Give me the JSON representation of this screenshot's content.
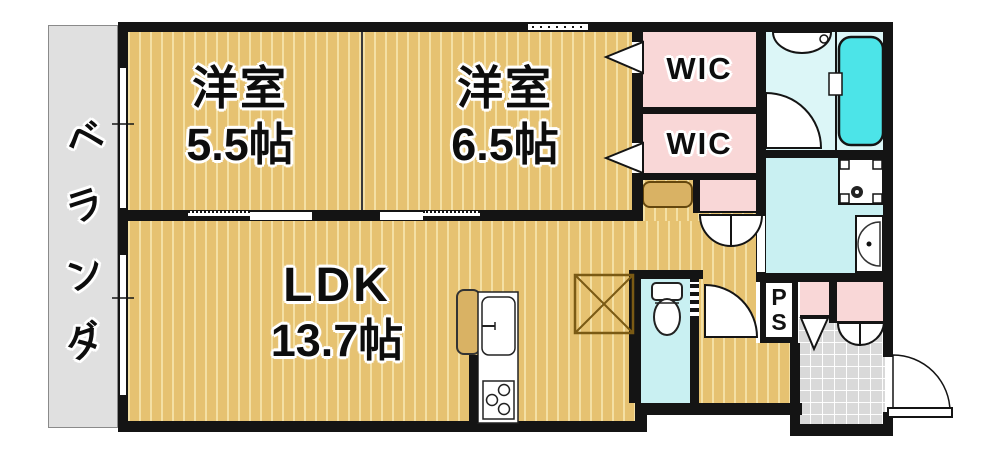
{
  "plan": {
    "veranda": {
      "label": "ベランダ"
    },
    "bedroom1": {
      "name": "洋室",
      "size": "5.5帖"
    },
    "bedroom2": {
      "name": "洋室",
      "size": "6.5帖"
    },
    "ldk": {
      "name": "LDK",
      "size": "13.7帖"
    },
    "wic1": {
      "label": "WIC"
    },
    "wic2": {
      "label": "WIC"
    },
    "pipe_space": {
      "line1": "P",
      "line2": "S"
    }
  },
  "colors": {
    "floor_tan": "#e6c271",
    "floor_stripe": "#f4e0a4",
    "counter_tan": "#d9b264",
    "pink": "#f9d7d7",
    "cyan_room": "#c9f0f2",
    "bath_floor": "#dcf6f7",
    "tub_cyan": "#4ce4e8",
    "veranda_gray": "#e0e0e0",
    "tile_gray": "#d9d9d9",
    "wall": "#141414"
  }
}
